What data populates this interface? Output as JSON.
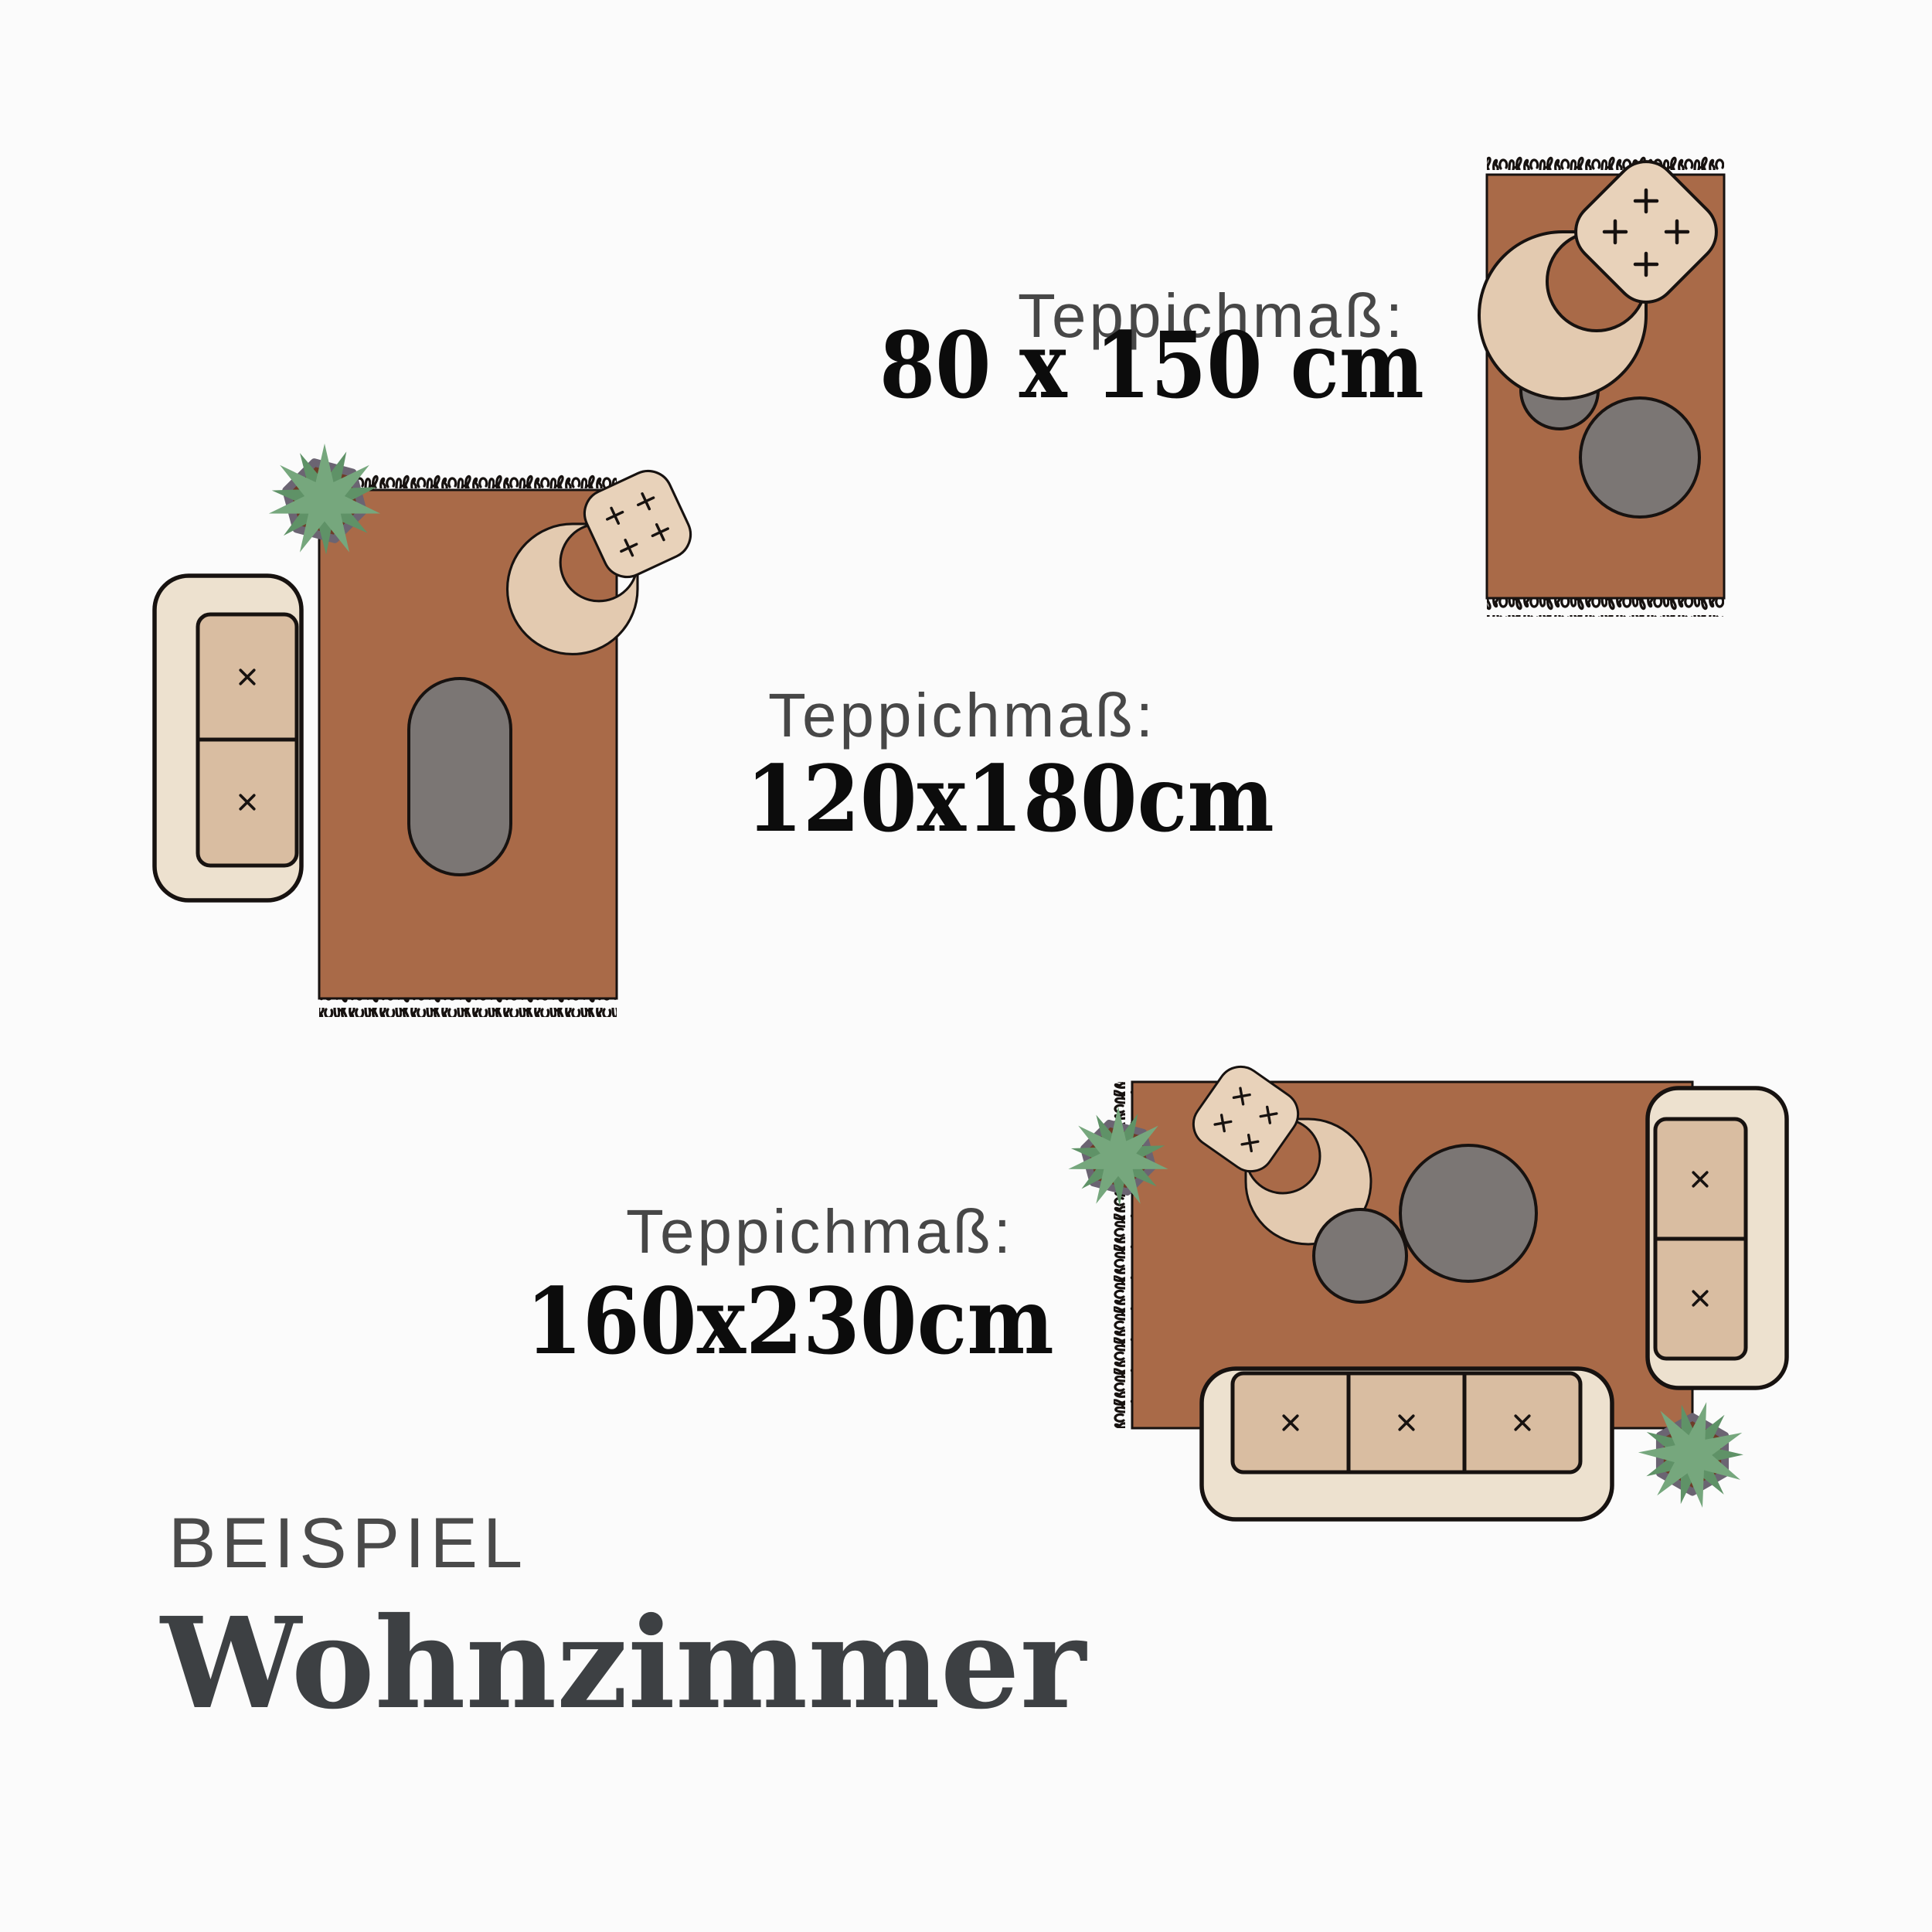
{
  "page": {
    "background": "#fbfbfb",
    "kind": "rug size guide infographic"
  },
  "labels": [
    {
      "title": "Teppichmaß:",
      "size": "80 x 150 cm"
    },
    {
      "title": "Teppichmaß:",
      "size": "120x180cm"
    },
    {
      "title": "Teppichmaß:",
      "size": "160x230cm"
    }
  ],
  "footer": {
    "eyebrow": "BEISPIEL",
    "title": "Wohnzimmer"
  },
  "colors": {
    "rug": "#a96a48",
    "outline": "#171210",
    "table_gray": "#7b7674",
    "sofa_shell": "#ede1cf",
    "cushion_tan": "#d9bda1",
    "chair_seat": "#e8d2ba",
    "chair_back": "#e3cab0",
    "leaf_green": "#76a77d",
    "leaf_green_dark": "#5f9267",
    "pot_brown": "#6e3c28",
    "pot_rim_gray": "#6b6472",
    "label_title_gray": "#474747",
    "label_size_black": "#0c0c0c",
    "heading_gray": "#3d4043"
  },
  "illustrations": [
    {
      "name": "rug-80x150-scene",
      "alt": "Rug 80 x 150 cm top view with armchair and two round side tables"
    },
    {
      "name": "rug-120x180-scene",
      "alt": "Rug 120 x 180 cm top view with two-seat sofa, armchair, oval table and plant"
    },
    {
      "name": "rug-160x230-scene",
      "alt": "Rug 160 x 230 cm top view with three-seat sofa, two-seat sofa, armchair, two round tables and plants"
    }
  ]
}
